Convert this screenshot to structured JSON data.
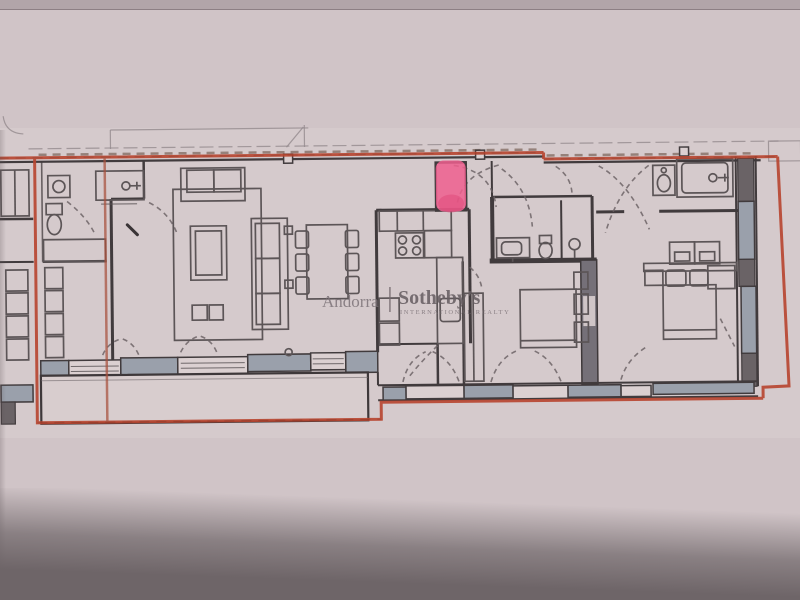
{
  "watermark": {
    "region": "Andorra",
    "divider": "|",
    "brand": "Sotheby's",
    "tagline": "INTERNATIONAL REALTY"
  },
  "highlight": {
    "name": "pink-marker-highlight",
    "color": "#ee5f8e",
    "color_edge": "#e04a7c"
  },
  "outline": {
    "name": "red-perimeter-trace",
    "color": "#b8452f",
    "color_secondary": "#a8503c"
  },
  "colors": {
    "paper": "#d0c4c7",
    "paper_light": "#d7cccd",
    "paper_top_strip": "#b2a5a9",
    "bottom_shadow": "#6e6568",
    "wall_dark": "#413b3d",
    "wall_gray_fill": "#9aa0ab",
    "furniture_line": "#5c5557",
    "watermark_gray": "#7d7378"
  }
}
